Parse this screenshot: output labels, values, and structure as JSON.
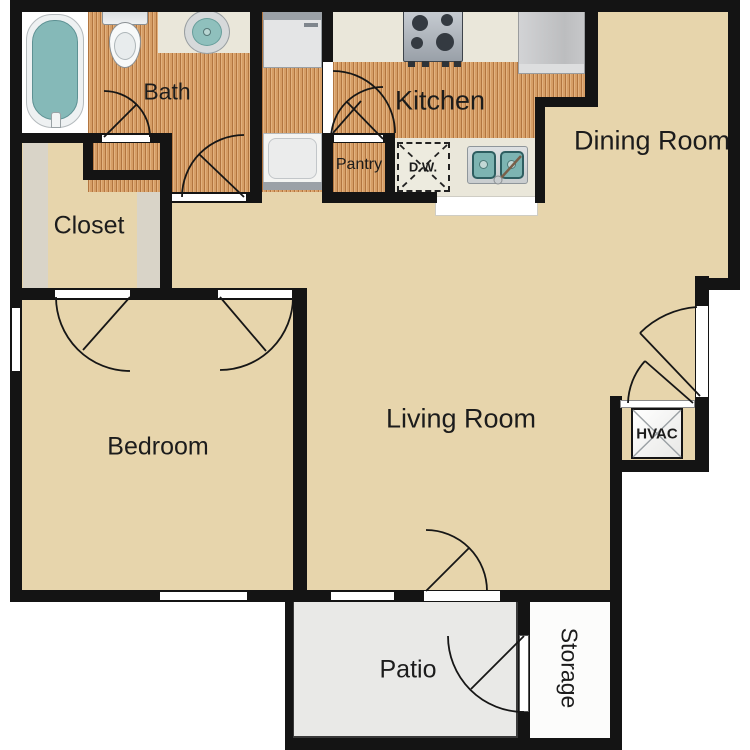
{
  "title": "One bed one bath apartment floor plan",
  "labels": {
    "bath": "Bath",
    "kitchen": "Kitchen",
    "pantry": "Pantry",
    "dishwasher": "D.W.",
    "dining": "Dining Room",
    "closet": "Closet",
    "living": "Living Room",
    "bedroom": "Bedroom",
    "hvac": "HVAC",
    "patio": "Patio",
    "storage": "Storage"
  },
  "colors": {
    "wall": "#141414",
    "floor_beige": "#e7d5ac",
    "floor_wood": "#d69e66",
    "counter": "#eae7da",
    "patio_floor": "#e9e9e7",
    "storage_floor": "#fcfcfb",
    "fixture_teal": "#85b9b8"
  }
}
